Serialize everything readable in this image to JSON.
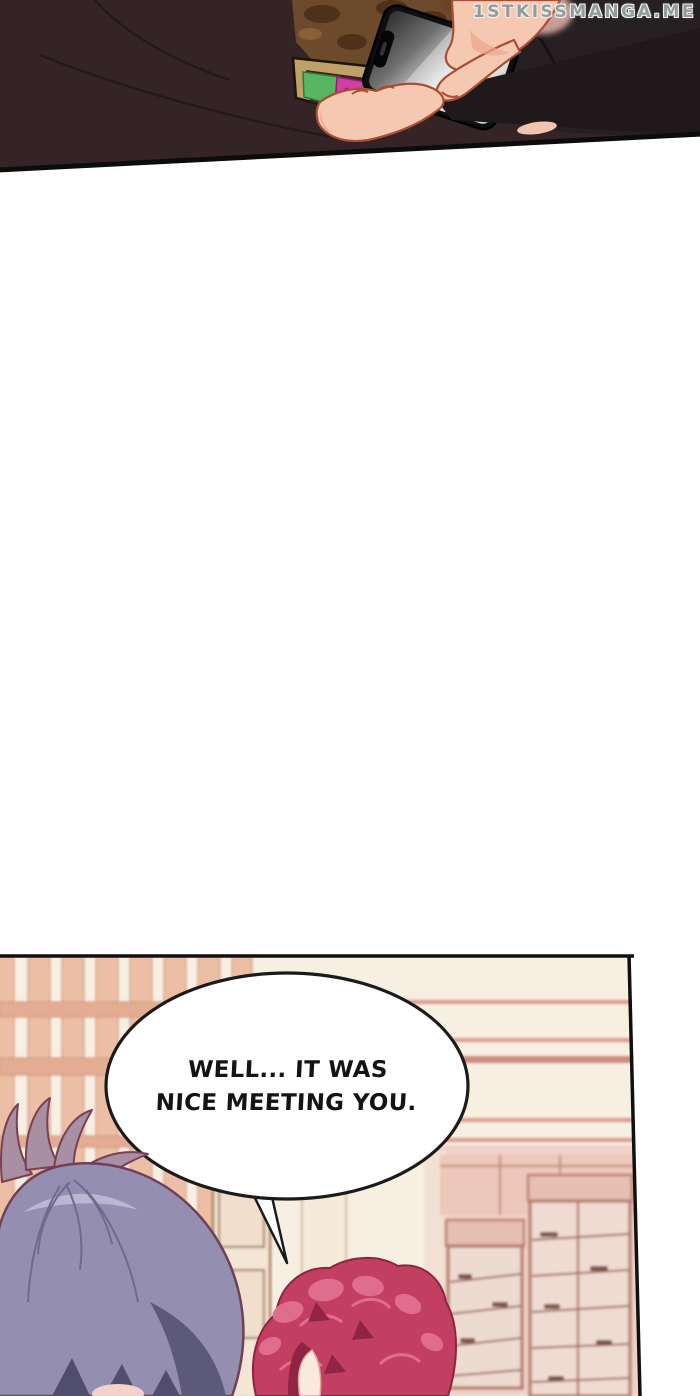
{
  "watermark": {
    "text": "1STKISSMANGA.ME"
  },
  "speech_bubble": {
    "line1": "WELL... IT WAS",
    "line2": "NICE MEETING YOU."
  },
  "palette": {
    "page_bg": "#ffffff",
    "panel_border": "#101010",
    "jacket": "#342425",
    "jacket_right": "#262023",
    "sleeve_dark": "#1f191b",
    "lining_brown": "#6e4a2c",
    "lining_blotch": "#4e3118",
    "wallet_tan": "#bfa06b",
    "card_green": "#58b562",
    "card_pink": "#cf3fa6",
    "phone_black": "#0f0f0f",
    "skin": "#f4c8b1",
    "skin_outline": "#a84e36",
    "blur_face": "#c79e97",
    "wall_cream": "#f8efe3",
    "slat_tan": "#ecbea4",
    "rail_tan": "#e4ad93",
    "stripe_salmon": "#d99a8c",
    "door_trim": "#9b7052",
    "window_green": "#c9cdb2",
    "cabinet_pink": "#eed2c7",
    "cabinet_frame": "#b97f71",
    "hair_purple": "#948fb0",
    "hair_purple_light": "#bcb6d2",
    "hair_purple_dark": "#5d5979",
    "hair_purple_outline": "#6e4156",
    "hair_red": "#c33f62",
    "hair_red_light": "#e06d8b",
    "hair_red_dark": "#8e2544",
    "face_skin": "#f9e9de",
    "bubble_fill": "#ffffff",
    "bubble_stroke": "#1b1b1b",
    "text_color": "#141414",
    "watermark_color": "#949c9a"
  }
}
